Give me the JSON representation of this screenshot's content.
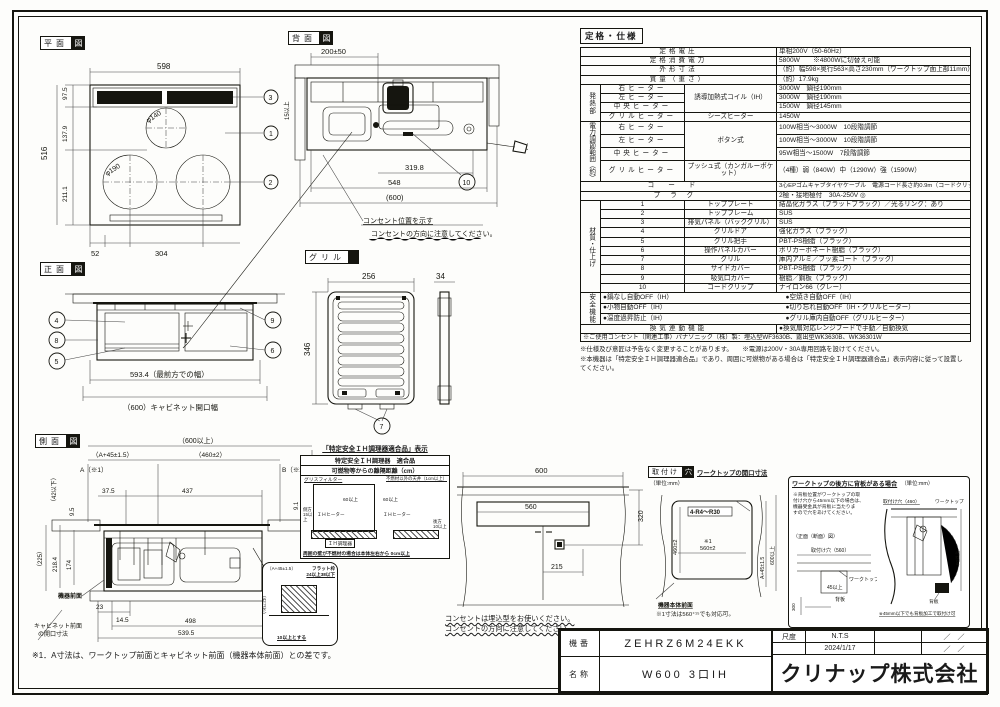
{
  "doc": {
    "kiban_label": "機番",
    "kiban": "ZEHRZ6M24EKK",
    "name_label": "名称",
    "name": "W600 3口IH",
    "scale_label": "尺度",
    "scale": "N.T.S",
    "date": "2024/1/17",
    "rev1": "／　／",
    "rev2": "／　／",
    "company": "クリナップ株式会社",
    "ink_color": "#15150f"
  },
  "plan": {
    "title_main": "平面",
    "title_inv": "図",
    "d_width": "598",
    "d_top": "97.5",
    "d_mid": "137.9",
    "d_low": "211.1",
    "d_height": "516",
    "d_left": "52",
    "d_center": "304",
    "dia_small": "φ140",
    "dia_big": "φ190",
    "callout_glass": "1",
    "callout_ring": "2",
    "callout_vent": "3"
  },
  "rear": {
    "title_main": "背面",
    "title_inv": "図",
    "d_outlet": "200±50",
    "d_inner": "319.8",
    "d_body": "548",
    "d_open": "(600)",
    "d_side": "15以上",
    "callout_clip": "10",
    "note1": "コンセント位置を示す",
    "note2": "コンセントの方向に注意してください。"
  },
  "front": {
    "title_main": "正面",
    "title_inv": "図",
    "d_front_width": "593.4（最前方での幅）",
    "d_cabinet": "（600）キャビネット開口幅",
    "callout_door": "4",
    "callout_side": "8",
    "callout_handle": "5",
    "callout_panel9": "9",
    "callout_panel6": "6"
  },
  "grill": {
    "title_main": "グリル",
    "title_inv": "",
    "d_width": "256",
    "d_thick": "34",
    "d_height": "346",
    "callout_pan": "7"
  },
  "side": {
    "title_main": "側面",
    "title_inv": "図",
    "d_over600": "（600以上）",
    "d_a45": "（A+45±1.5）",
    "d_460": "（460±2）",
    "d_a": "A（※1）",
    "d_b": "B（※2）",
    "d_42": "（42以下）",
    "d_95": "9.5",
    "d_375": "37.5",
    "d_437": "437",
    "d_91": "9.1",
    "d_1042": "（10～42）",
    "d_225": "（225）",
    "d_2184": "218.4",
    "d_174": "174",
    "d_23": "23",
    "d_145": "14.5",
    "d_498": "498",
    "d_5395": "539.5",
    "lbl_front": "機器前面",
    "lbl_cabinet1": "キャビネット前面",
    "lbl_cabinet2": "の開口寸法",
    "note": "※1．A寸法は、ワークトップ前面とキャビネット前面（機器本体前面）との差です。"
  },
  "cert": {
    "title": "「特定安全ＩＨ調理器適合品」表示",
    "head1": "特定安全ＩＨ調理器　適合品",
    "head2": "可燃物等からの離隔距離（cm）",
    "lbl_filter": "グリスフィルター",
    "lbl_ceiling": "不燃材以外の天井（1cm以上）",
    "d60a": "60以上",
    "d60b": "60以上",
    "lbl_ih1": "ＩＨヒーター",
    "lbl_ih2": "ＩＨヒーター",
    "lbl_side": "側方 15以上",
    "lbl_rear": "後方 10以上",
    "lbl_cooker": "ＩＨ調理器",
    "foot": "周囲の壁が不燃材の場合は本体左右から 0cm以上"
  },
  "detail": {
    "d_a45": "（A+45±1.5）",
    "lbl_frame1": "フラット枠",
    "lbl_frame2": "24以上38以下",
    "d_42": "（42以下）",
    "foot": "10以上とする"
  },
  "cabinet": {
    "d_600": "600",
    "d_560": "560",
    "d_320": "320",
    "d_215": "215",
    "note1": "コンセントは埋込型をお使いください。",
    "note2": "コンセントの方向に注意してください。"
  },
  "mount": {
    "title_main": "取付け",
    "title_inv": "穴",
    "subtitle": "ワークトップの開口寸法",
    "unit": "（単位:mm）",
    "corner": "4-R4～R30",
    "d_460": "460±2",
    "ref": "※1",
    "d_560": "560±2",
    "d_a45": "A+45±1.5",
    "d_600": "600以上",
    "lbl_front": "機器本体前面",
    "note": "※1寸法は560⁺¹⁵でも対応可。"
  },
  "backpanel": {
    "title": "ワークトップの後方に背板がある場合",
    "unit": "（単位:mm）",
    "note1": "※背板位置がワークトップの取",
    "note2": "付け穴から45mm以下の場合は、",
    "note3": "機器受金具が背板に当たりま",
    "note4": "すので穴をあけてください。",
    "sub": "（正面（断面）図）",
    "lbl_hole560": "取付け穴（560）",
    "lbl_hole460": "取付け穴（460）",
    "lbl_worktop1": "ワークトップ",
    "lbl_worktop2": "ワークトップ",
    "lbl_back1": "背板",
    "lbl_back2": "背板",
    "d_300": "300",
    "d_45": "45以上",
    "d_60": "60以上",
    "foot": "※45mm以下でも背板加工で取付け可"
  },
  "spec": {
    "header": "定格・仕様",
    "voltage_label": "定格電圧",
    "voltage": "単相200V（50-60Hz）",
    "power_label": "定格消費電力",
    "power": "5800W　　※4800Wに切替え可能",
    "size_label": "外形寸法",
    "size": "（約）幅598×奥行563×高さ230mm（ワークトップ面上部11mm）",
    "weight_label": "質量（重さ）",
    "weight": "（約）17.9kg",
    "heater_group": "発熱部",
    "right_heater": "右ヒーター",
    "ih_type": "誘導加熱式コイル（IH）",
    "right_val": "3000W　鍋径190mm",
    "left_heater": "左ヒーター",
    "left_val": "3000W　鍋径190mm",
    "center_heater": "中央ヒーター",
    "center_val": "1500W　鍋径145mm",
    "grill_heater": "グリルヒーター",
    "grill_type": "シーズヒーター",
    "grill_val": "1450W",
    "range_group": "電力調節範囲（約）",
    "range_type": "ボタン式",
    "range_right": "右ヒーター",
    "range_right_val": "100W相当～3000W　10段階調節",
    "range_left": "左ヒーター",
    "range_left_val": "100W相当～3000W　10段階調節",
    "range_center": "中央ヒーター",
    "range_center_val": "95W相当～1500W　7段階調節",
    "range_grill": "グリルヒーター",
    "range_grill_type": "プッシュ式（カンガルーポケット）",
    "range_grill_val": "（4種）弱（840W）中（1290W）強（1590W）",
    "cord_label": "コード",
    "cord": "3心EPゴムキャブタイヤケーブル　電源コード長さ約0.9m（コードクリップ部まで約0.7m）",
    "plug_label": "プラグ",
    "plug": "2極・接地極付　30A-250V",
    "plug_icon": "◎",
    "material_group": "材質・仕上げ",
    "materials": [
      {
        "no": "1",
        "label": "トッププレート",
        "value": "結晶化ガラス（フラットブラック）／光るリング：あり"
      },
      {
        "no": "2",
        "label": "トップフレーム",
        "value": "SUS"
      },
      {
        "no": "3",
        "label": "排気パネル（バックグリル）",
        "value": "SUS"
      },
      {
        "no": "4",
        "label": "グリルドア",
        "value": "強化ガラス（ブラック）"
      },
      {
        "no": "5",
        "label": "グリル把手",
        "value": "PBT-PS樹脂（ブラック）"
      },
      {
        "no": "6",
        "label": "操作パネルカバー",
        "value": "ポリカーボネート樹脂（ブラック）"
      },
      {
        "no": "7",
        "label": "グリル",
        "value": "庫内アルミ／フッ素コート（ブラック）"
      },
      {
        "no": "8",
        "label": "サイドカバー",
        "value": "PBT-PS樹脂（ブラック）"
      },
      {
        "no": "9",
        "label": "吸気口カバー",
        "value": "樹脂／鋼板（ブラック）"
      },
      {
        "no": "10",
        "label": "コードクリップ",
        "value": "ナイロン66（グレー）"
      }
    ],
    "safety_group": "安全機能",
    "safety": [
      {
        "l": "●鍋なし自動OFF（IH）",
        "r": "●空焼き自動OFF（IH）"
      },
      {
        "l": "●小物自動OFF（IH）",
        "r": "●切り忘れ自動OFF（IH・グリルヒーター）"
      },
      {
        "l": "●温度過昇防止（IH）",
        "r": "●グリル庫内自動OFF（グリルヒーター）"
      }
    ],
    "vent_label": "換気連動機能",
    "vent": "●換気扇対応レンジフードで手動／自動換気",
    "outlet_note": "※ご使用コンセント（関連工事）パナソニック（株）製：埋込型WF3630B、露出型WK3630B、WK36301W",
    "note1": "※仕様及び意匠は予告なく変更することがあります。　　※電源は200V・30A専用回路を設けてください。",
    "note2": "※本機器は「特定安全ＩＨ調理器適合品」であり、周囲に可燃物がある場合は「特定安全ＩＨ調理器適合品」表示内容に従って設置してください。"
  }
}
